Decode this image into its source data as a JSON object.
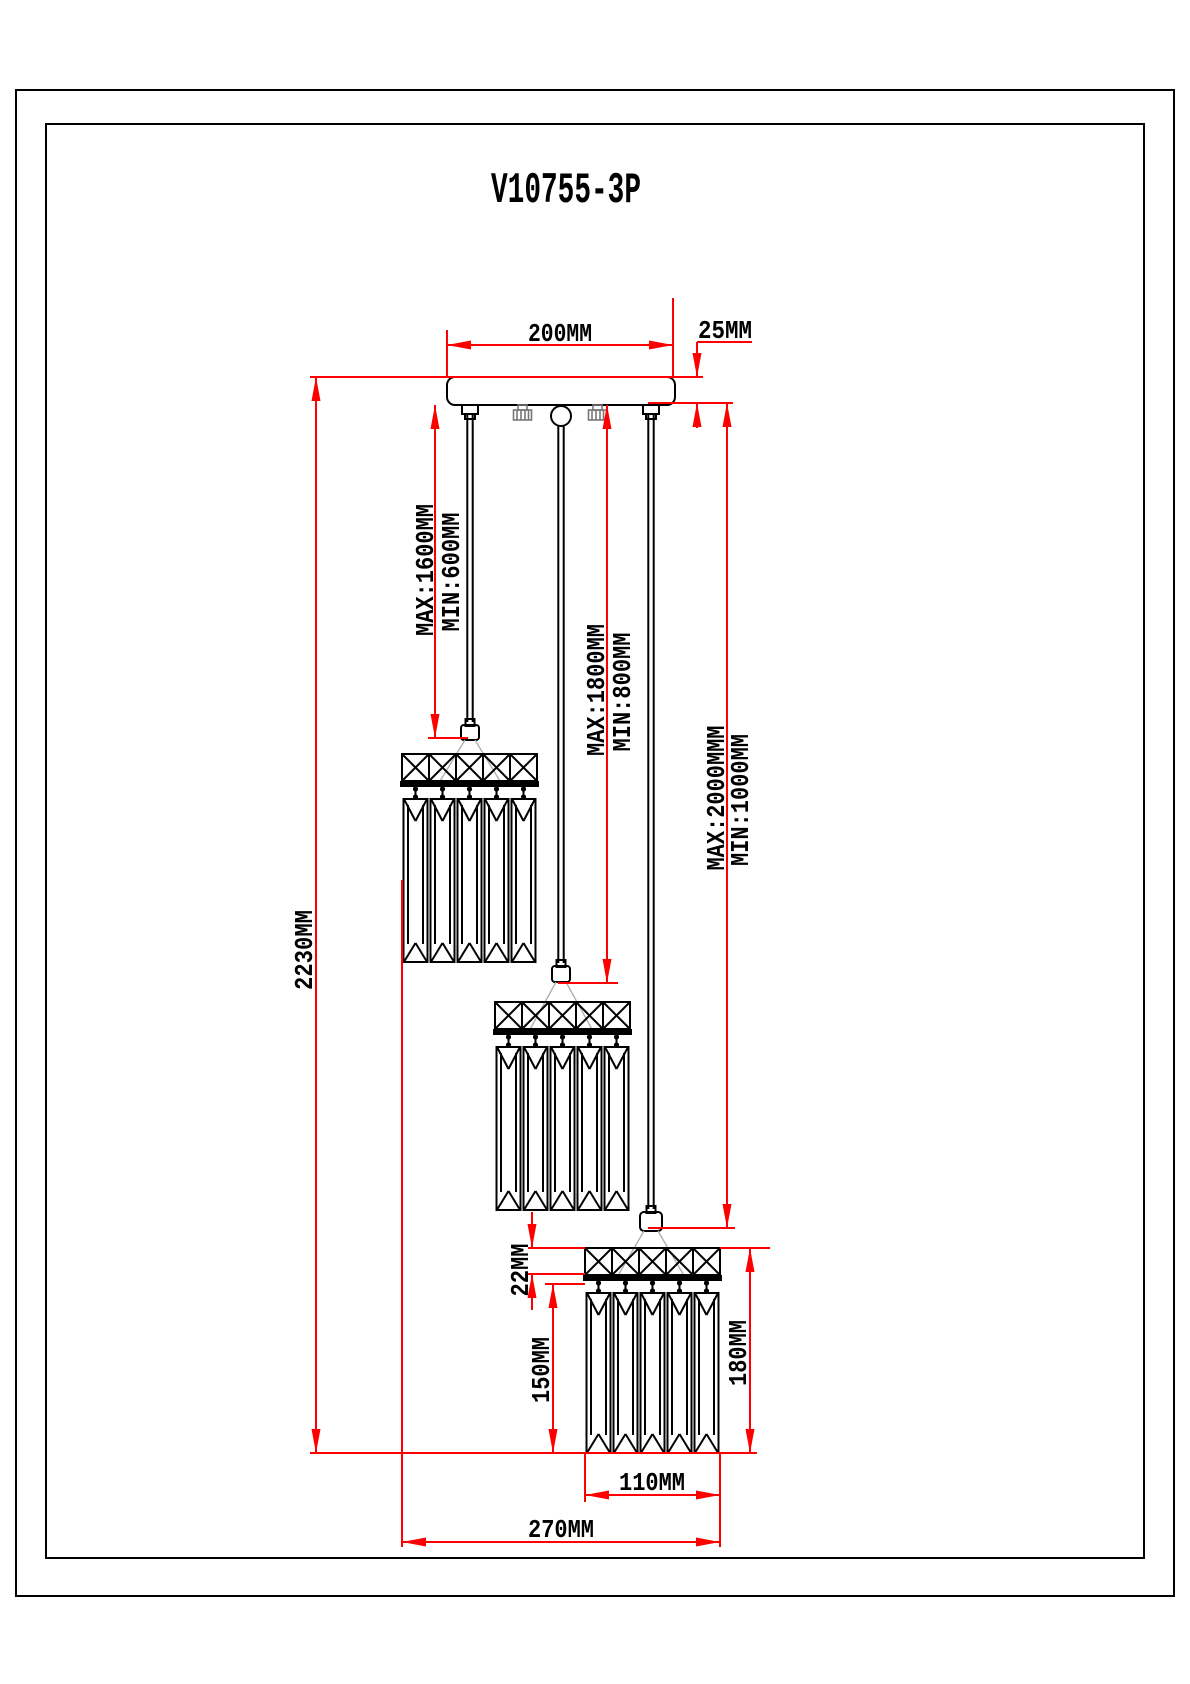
{
  "title": "V10755-3P",
  "colors": {
    "outline": "#000000",
    "dimension": "#FF0000",
    "wire": "#ACACAC",
    "screw_hatch": "#777777",
    "background": "#FFFFFF"
  },
  "dimensions": {
    "canopy_width": "200MM",
    "canopy_thickness": "25MM",
    "cord1_max": "MAX:1600MM",
    "cord1_min": "MIN:600MM",
    "cord2_max": "MAX:1800MM",
    "cord2_min": "MIN:800MM",
    "cord3_max": "MAX:2000MMM",
    "cord3_min": "MIN:1000MM",
    "overall_height": "2230MM",
    "crystal_band_height": "22MM",
    "prism_drop_length": "150MM",
    "shade_total_height": "180MM",
    "shade_width": "110MM",
    "fixture_spread_width": "270MM"
  }
}
